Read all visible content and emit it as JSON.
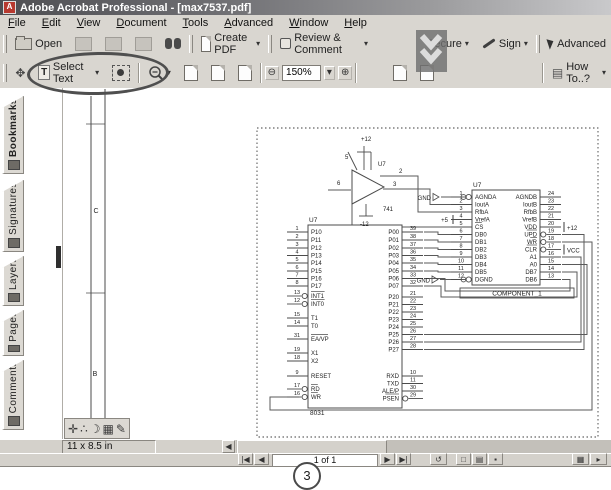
{
  "window": {
    "title": "Adobe Acrobat Professional - [max7537.pdf]",
    "app_icon": "A"
  },
  "menu": {
    "items": [
      "File",
      "Edit",
      "View",
      "Document",
      "Tools",
      "Advanced",
      "Window",
      "Help"
    ]
  },
  "toolbar_file": {
    "open_label": "Open",
    "create_pdf_label": "Create PDF",
    "review_label": "Review & Comment",
    "secure_label": "Secure",
    "sign_label": "Sign",
    "advanced_label": "Advanced"
  },
  "toolbar_view": {
    "select_text_letter": "T",
    "select_text_label": "Select Text",
    "zoom_value": "150%",
    "zoom_out_glyph": "⊖",
    "zoom_in_glyph": "⊕",
    "how_to_label": "How To..?",
    "dropdown_glyph": "▾"
  },
  "sidebar": {
    "tabs": [
      {
        "label": "Bookmarks",
        "active": true
      },
      {
        "label": "Signatures",
        "active": false
      },
      {
        "label": "Layers",
        "active": false
      },
      {
        "label": "Pages",
        "active": false
      },
      {
        "label": "Comments",
        "active": false
      }
    ]
  },
  "statusbar": {
    "page_size": "11 x 8.5 in",
    "page_nav": "1 of 1",
    "first_glyph": "|◀",
    "prev_glyph": "◀",
    "next_glyph": "▶",
    "last_glyph": "▶|",
    "scroll_left_glyph": "◀",
    "prev_view_glyph": "↺",
    "view_buttons": [
      "□",
      "▤",
      "▪"
    ],
    "right_buttons": [
      "▦",
      "▸"
    ],
    "palette_icons": [
      "✛",
      "∴",
      "☽",
      "▦",
      "✎"
    ]
  },
  "annotation": {
    "step_number": "3"
  },
  "schematic": {
    "sheet_frame": {
      "vlines": [
        [
          91,
          96,
          437
        ],
        [
          105,
          89,
          437
        ]
      ],
      "ticks": [
        [
          86,
          105,
          124
        ],
        [
          86,
          105,
          293
        ]
      ],
      "zone_labels": [
        {
          "t": "C",
          "x": 96,
          "y": 213
        },
        {
          "t": "B",
          "x": 95,
          "y": 376
        }
      ]
    },
    "border": [
      257,
      128,
      341,
      309
    ],
    "ics": [
      {
        "ref": "U7",
        "part": "8031",
        "box": [
          308,
          225,
          402,
          408
        ],
        "left": [
          [
            "1",
            "P10",
            232,
            0,
            0
          ],
          [
            "2",
            "P11",
            240,
            0,
            0
          ],
          [
            "3",
            "P12",
            248,
            0,
            0
          ],
          [
            "4",
            "P13",
            255.5,
            0,
            0
          ],
          [
            "5",
            "P14",
            263,
            0,
            0
          ],
          [
            "6",
            "P15",
            271,
            0,
            0
          ],
          [
            "7",
            "P16",
            278.5,
            0,
            0
          ],
          [
            "8",
            "P17",
            286,
            0,
            0
          ],
          [
            "13",
            "INT1",
            296,
            1,
            1
          ],
          [
            "12",
            "INT0",
            304,
            1,
            1
          ],
          [
            "15",
            "T1",
            318,
            0,
            0
          ],
          [
            "14",
            "T0",
            326,
            0,
            0
          ],
          [
            "31",
            "EA/VP",
            339,
            0,
            1
          ],
          [
            "19",
            "X1",
            353,
            0,
            0
          ],
          [
            "18",
            "X2",
            361,
            0,
            0
          ],
          [
            "9",
            "RESET",
            376,
            0,
            0
          ],
          [
            "17",
            "RD",
            389,
            1,
            1
          ],
          [
            "16",
            "WR",
            397,
            1,
            1
          ]
        ],
        "right": [
          [
            "39",
            "P00",
            232,
            0,
            0
          ],
          [
            "38",
            "P01",
            240,
            0,
            0
          ],
          [
            "37",
            "P02",
            248,
            0,
            0
          ],
          [
            "36",
            "P03",
            255.5,
            0,
            0
          ],
          [
            "35",
            "P04",
            263,
            0,
            0
          ],
          [
            "34",
            "P05",
            271,
            0,
            0
          ],
          [
            "33",
            "P06",
            278.5,
            0,
            0
          ],
          [
            "32",
            "P07",
            286,
            0,
            0
          ],
          [
            "21",
            "P20",
            297,
            0,
            0
          ],
          [
            "22",
            "P21",
            304.5,
            0,
            0
          ],
          [
            "23",
            "P22",
            312,
            0,
            0
          ],
          [
            "24",
            "P23",
            319.5,
            0,
            0
          ],
          [
            "25",
            "P24",
            327,
            0,
            0
          ],
          [
            "26",
            "P25",
            334.5,
            0,
            0
          ],
          [
            "27",
            "P26",
            342,
            0,
            0
          ],
          [
            "28",
            "P27",
            349.5,
            0,
            0
          ],
          [
            "10",
            "RXD",
            376,
            0,
            0
          ],
          [
            "11",
            "TXD",
            383.5,
            0,
            0
          ],
          [
            "30",
            "ALE/P",
            391,
            0,
            0
          ],
          [
            "29",
            "PSEN",
            398.5,
            1,
            1
          ]
        ]
      },
      {
        "ref": "U7",
        "part": "COMPONENT_1",
        "part_box": [
          460,
          288,
          574,
          298
        ],
        "box": [
          472,
          190,
          540,
          285
        ],
        "left": [
          [
            "1",
            "AGNDA",
            197,
            1,
            0
          ],
          [
            "2",
            "IoutA",
            204.5,
            0,
            0
          ],
          [
            "3",
            "RfbA",
            212,
            0,
            0
          ],
          [
            "4",
            "VrefA",
            219.5,
            0,
            0
          ],
          [
            "5",
            "CS",
            227,
            0,
            1
          ],
          [
            "6",
            "DB0",
            234.5,
            0,
            0
          ],
          [
            "7",
            "DB1",
            242,
            0,
            0
          ],
          [
            "8",
            "DB2",
            249.5,
            0,
            0
          ],
          [
            "9",
            "DB3",
            257,
            0,
            0
          ],
          [
            "10",
            "DB4",
            264.5,
            0,
            0
          ],
          [
            "11",
            "DB5",
            272,
            0,
            0
          ],
          [
            "12",
            "DGND",
            279.5,
            1,
            0
          ]
        ],
        "right": [
          [
            "24",
            "AGNDB",
            197,
            0,
            0
          ],
          [
            "23",
            "IoutB",
            204.5,
            0,
            0
          ],
          [
            "22",
            "RfbB",
            212,
            0,
            0
          ],
          [
            "21",
            "VrefB",
            219.5,
            0,
            0
          ],
          [
            "20",
            "VDD",
            227,
            0,
            0
          ],
          [
            "19",
            "UPD",
            234.5,
            1,
            1
          ],
          [
            "18",
            "WR",
            242,
            1,
            1
          ],
          [
            "17",
            "CLR",
            249.5,
            1,
            1
          ],
          [
            "16",
            "A1",
            257,
            0,
            0
          ],
          [
            "15",
            "A0",
            264.5,
            0,
            0
          ],
          [
            "14",
            "DB7",
            272,
            0,
            0
          ],
          [
            "13",
            "DB6",
            279.5,
            0,
            0
          ]
        ]
      }
    ],
    "opamp": {
      "ref": "U7",
      "part": "741",
      "points": "352,170 352,204 384,187",
      "labels": [
        [
          "6",
          337,
          185
        ],
        [
          "2",
          399,
          173
        ],
        [
          "3",
          393,
          186
        ],
        [
          "5",
          345,
          159
        ],
        [
          "+12",
          361,
          141
        ],
        [
          "-12",
          360,
          226
        ],
        [
          "U7",
          378,
          166
        ],
        [
          "741",
          383,
          211
        ]
      ],
      "lines": [
        [
          364,
          146,
          364,
          170
        ],
        [
          371,
          152,
          371,
          170
        ],
        [
          357,
          170,
          348,
          152
        ],
        [
          357,
          152,
          371,
          152
        ],
        [
          366,
          204,
          366,
          216
        ],
        [
          359,
          216,
          373,
          216
        ]
      ]
    },
    "wires": [
      [
        [
          328,
          190
        ],
        [
          351,
          190
        ]
      ],
      [
        [
          380,
          176
        ],
        [
          418,
          176
        ],
        [
          418,
          212
        ],
        [
          451,
          212
        ]
      ],
      [
        [
          383,
          189
        ],
        [
          430,
          189
        ],
        [
          430,
          204.5
        ],
        [
          451,
          204.5
        ]
      ],
      [
        [
          352,
          202
        ],
        [
          352,
          227
        ],
        [
          451,
          227
        ]
      ],
      [
        [
          424,
          232
        ],
        [
          438,
          232
        ],
        [
          438,
          234.5
        ],
        [
          451,
          234.5
        ]
      ],
      [
        [
          424,
          240
        ],
        [
          438,
          240
        ],
        [
          438,
          242
        ],
        [
          451,
          242
        ]
      ],
      [
        [
          424,
          248
        ],
        [
          438,
          248
        ],
        [
          438,
          249.5
        ],
        [
          451,
          249.5
        ]
      ],
      [
        [
          424,
          255.5
        ],
        [
          438,
          255.5
        ],
        [
          438,
          257
        ],
        [
          451,
          257
        ]
      ],
      [
        [
          424,
          263
        ],
        [
          438,
          263
        ],
        [
          438,
          264.5
        ],
        [
          451,
          264.5
        ]
      ],
      [
        [
          424,
          271
        ],
        [
          438,
          271
        ],
        [
          438,
          272
        ],
        [
          451,
          272
        ]
      ],
      [
        [
          424,
          286
        ],
        [
          441,
          286
        ],
        [
          441,
          297
        ],
        [
          577,
          297
        ],
        [
          577,
          272
        ],
        [
          562,
          272
        ]
      ],
      [
        [
          424,
          278.5
        ],
        [
          445,
          278.5
        ],
        [
          445,
          291
        ],
        [
          570,
          291
        ],
        [
          570,
          279.5
        ],
        [
          562,
          279.5
        ]
      ],
      [
        [
          299,
          397
        ],
        [
          270,
          397
        ],
        [
          270,
          410
        ],
        [
          592,
          410
        ],
        [
          592,
          242
        ],
        [
          562,
          242
        ]
      ],
      [
        [
          562,
          234.5
        ],
        [
          584,
          234.5
        ],
        [
          584,
          349.5
        ],
        [
          424,
          349.5
        ]
      ],
      [
        [
          562,
          257
        ],
        [
          581,
          257
        ],
        [
          581,
          342
        ],
        [
          424,
          342
        ]
      ],
      [
        [
          562,
          264.5
        ],
        [
          587,
          264.5
        ],
        [
          587,
          334.5
        ],
        [
          424,
          334.5
        ]
      ],
      [
        [
          441,
          197
        ],
        [
          461,
          197
        ]
      ],
      [
        [
          440,
          279.5
        ],
        [
          461,
          279.5
        ]
      ]
    ],
    "bubbles": [
      [
        463.5,
        197
      ],
      [
        463.5,
        279.5
      ]
    ],
    "gnd_flags": [
      {
        "t": "GND",
        "x": 431,
        "y": 200,
        "tri": "433,193.5 433,200.5 439,197"
      },
      {
        "t": "GND",
        "x": 430,
        "y": 282.5,
        "tri": "432,276 432,283 438,279.5"
      }
    ],
    "power_taps": [
      {
        "t": "+5",
        "x": 448,
        "y": 222,
        "bar": [
          453,
          215,
          453,
          224
        ],
        "anchor": "end"
      },
      {
        "t": "+12",
        "x": 567,
        "y": 230,
        "bar": [
          564,
          222,
          564,
          232
        ],
        "anchor": "start"
      },
      {
        "t": "VCC",
        "x": 567,
        "y": 252.5,
        "bar": [
          564,
          244.5,
          564,
          254.5
        ],
        "anchor": "start"
      }
    ]
  }
}
